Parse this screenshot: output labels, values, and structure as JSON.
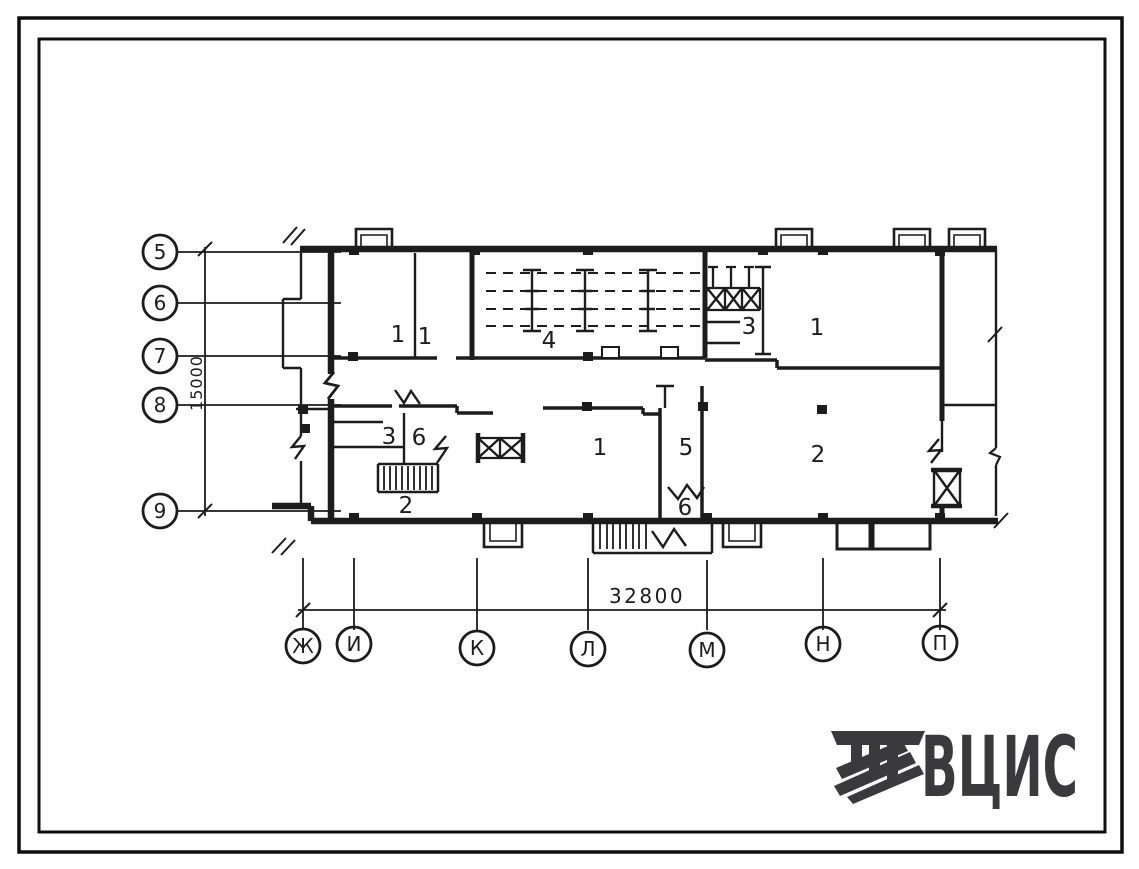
{
  "drawing_type": "floor-plan",
  "vertical_axes": {
    "dimension": "15000",
    "items": [
      "5",
      "6",
      "7",
      "8",
      "9"
    ]
  },
  "horizontal_axes": {
    "dimension": "32800",
    "items": [
      "Ж",
      "И",
      "К",
      "Л",
      "М",
      "Н",
      "П"
    ]
  },
  "room_labels": [
    "1",
    "1",
    "4",
    "3",
    "1",
    "3",
    "6",
    "2",
    "1",
    "5",
    "6",
    "2"
  ],
  "logo": {
    "text": "ВЦИС"
  },
  "colors": {
    "ink": "#1c1c1c",
    "logo": "#3a3a3d",
    "paper": "#ffffff"
  }
}
